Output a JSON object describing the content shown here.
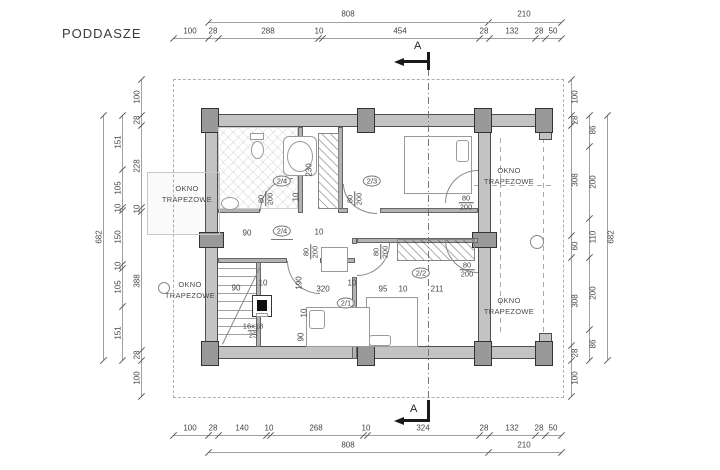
{
  "title": "PODDASZE",
  "section_marker": "A",
  "stair_note": {
    "num": "16x18",
    "den": "25"
  },
  "window_label_text": "OKNO TRAPEZOWE",
  "colors": {
    "wall": "#c3c3c3",
    "line": "#a0a0a0",
    "text": "#444444",
    "section": "#1a1a1a"
  },
  "room_tags": [
    {
      "t": "2/4",
      "x": 282,
      "y": 181,
      "ul": false
    },
    {
      "t": "2/4",
      "x": 282,
      "y": 231,
      "ul": true
    },
    {
      "t": "2/3",
      "x": 372,
      "y": 181,
      "ul": false
    },
    {
      "t": "2/2",
      "x": 421,
      "y": 273,
      "ul": false
    },
    {
      "t": "2/1",
      "x": 346,
      "y": 303,
      "ul": false
    }
  ],
  "window_labels": [
    {
      "line1": "OKNO",
      "line2": "TRAPEZOWE",
      "x": 187,
      "y": 183,
      "circle": false
    },
    {
      "line1": "OKNO",
      "line2": "TRAPEZOWE",
      "x": 190,
      "y": 279,
      "circle": true
    },
    {
      "line1": "OKNO",
      "line2": "TRAPEZOWE",
      "x": 509,
      "y": 165,
      "circle": false
    },
    {
      "line1": "OKNO",
      "line2": "TRAPEZOWE",
      "x": 509,
      "y": 295,
      "circle": false
    }
  ],
  "door_labels": [
    {
      "num": "80",
      "den": "200",
      "x": 266,
      "y": 199,
      "rot": true
    },
    {
      "num": "80",
      "den": "200",
      "x": 355,
      "y": 199,
      "rot": true
    },
    {
      "num": "80",
      "den": "200",
      "x": 466,
      "y": 203,
      "rot": false
    },
    {
      "num": "80",
      "den": "200",
      "x": 311,
      "y": 252,
      "rot": true
    },
    {
      "num": "80",
      "den": "200",
      "x": 381,
      "y": 252,
      "rot": true
    },
    {
      "num": "80",
      "den": "200",
      "x": 467,
      "y": 270,
      "rot": false
    }
  ],
  "interior_dims": [
    {
      "t": "230",
      "x": 309,
      "y": 170,
      "rot": true
    },
    {
      "t": "10",
      "x": 296,
      "y": 197,
      "rot": true
    },
    {
      "t": "90",
      "x": 247,
      "y": 233,
      "rot": false
    },
    {
      "t": "10",
      "x": 319,
      "y": 232,
      "rot": false
    },
    {
      "t": "90",
      "x": 236,
      "y": 288,
      "rot": false
    },
    {
      "t": "10",
      "x": 263,
      "y": 283,
      "rot": false
    },
    {
      "t": "190",
      "x": 299,
      "y": 283,
      "rot": true
    },
    {
      "t": "320",
      "x": 323,
      "y": 289,
      "rot": false
    },
    {
      "t": "10",
      "x": 352,
      "y": 283,
      "rot": false
    },
    {
      "t": "95",
      "x": 383,
      "y": 289,
      "rot": false
    },
    {
      "t": "10",
      "x": 403,
      "y": 289,
      "rot": false
    },
    {
      "t": "211",
      "x": 437,
      "y": 289,
      "rot": false
    },
    {
      "t": "10",
      "x": 304,
      "y": 313,
      "rot": true
    },
    {
      "t": "90",
      "x": 301,
      "y": 337,
      "rot": true
    }
  ],
  "dims": {
    "top_totals": {
      "rot": false,
      "y": 14,
      "items": [
        {
          "t": "808",
          "x": 348
        },
        {
          "t": "210",
          "x": 524
        }
      ]
    },
    "top_segments": {
      "rot": false,
      "y": 31,
      "items": [
        {
          "t": "100",
          "x": 190
        },
        {
          "t": "28",
          "x": 213
        },
        {
          "t": "288",
          "x": 268
        },
        {
          "t": "10",
          "x": 319
        },
        {
          "t": "454",
          "x": 400
        },
        {
          "t": "28",
          "x": 484
        },
        {
          "t": "132",
          "x": 512
        },
        {
          "t": "28",
          "x": 539
        },
        {
          "t": "50",
          "x": 553
        }
      ]
    },
    "bottom_segments": {
      "rot": false,
      "y": 428,
      "items": [
        {
          "t": "100",
          "x": 190
        },
        {
          "t": "28",
          "x": 213
        },
        {
          "t": "140",
          "x": 242
        },
        {
          "t": "10",
          "x": 269
        },
        {
          "t": "268",
          "x": 316
        },
        {
          "t": "10",
          "x": 366
        },
        {
          "t": "324",
          "x": 423
        },
        {
          "t": "28",
          "x": 484
        },
        {
          "t": "132",
          "x": 512
        },
        {
          "t": "28",
          "x": 539
        },
        {
          "t": "50",
          "x": 553
        }
      ]
    },
    "bottom_totals": {
      "rot": false,
      "y": 445,
      "items": [
        {
          "t": "808",
          "x": 348
        },
        {
          "t": "210",
          "x": 524
        }
      ]
    },
    "left_outer": {
      "rot": true,
      "x": 99,
      "items": [
        {
          "t": "682",
          "y": 237
        }
      ]
    },
    "left_mid": {
      "rot": true,
      "x": 118,
      "items": [
        {
          "t": "151",
          "y": 142
        },
        {
          "t": "105",
          "y": 188
        },
        {
          "t": "10",
          "y": 208
        },
        {
          "t": "150",
          "y": 237
        },
        {
          "t": "10",
          "y": 266
        },
        {
          "t": "105",
          "y": 287
        },
        {
          "t": "151",
          "y": 333
        }
      ]
    },
    "left_inner": {
      "rot": true,
      "x": 137,
      "items": [
        {
          "t": "100",
          "y": 97
        },
        {
          "t": "28",
          "y": 120
        },
        {
          "t": "228",
          "y": 166
        },
        {
          "t": "10",
          "y": 209
        },
        {
          "t": "388",
          "y": 281
        },
        {
          "t": "28",
          "y": 355
        },
        {
          "t": "100",
          "y": 378
        }
      ]
    },
    "right_inner": {
      "rot": true,
      "x": 575,
      "items": [
        {
          "t": "100",
          "y": 97
        },
        {
          "t": "28",
          "y": 120
        },
        {
          "t": "308",
          "y": 180
        },
        {
          "t": "60",
          "y": 246
        },
        {
          "t": "308",
          "y": 301
        },
        {
          "t": "28",
          "y": 353
        },
        {
          "t": "100",
          "y": 378
        }
      ]
    },
    "right_mid": {
      "rot": true,
      "x": 593,
      "items": [
        {
          "t": "86",
          "y": 130
        },
        {
          "t": "200",
          "y": 182
        },
        {
          "t": "110",
          "y": 237
        },
        {
          "t": "200",
          "y": 293
        },
        {
          "t": "86",
          "y": 344
        }
      ]
    },
    "right_outer": {
      "rot": true,
      "x": 611,
      "items": [
        {
          "t": "682",
          "y": 237
        }
      ]
    }
  }
}
